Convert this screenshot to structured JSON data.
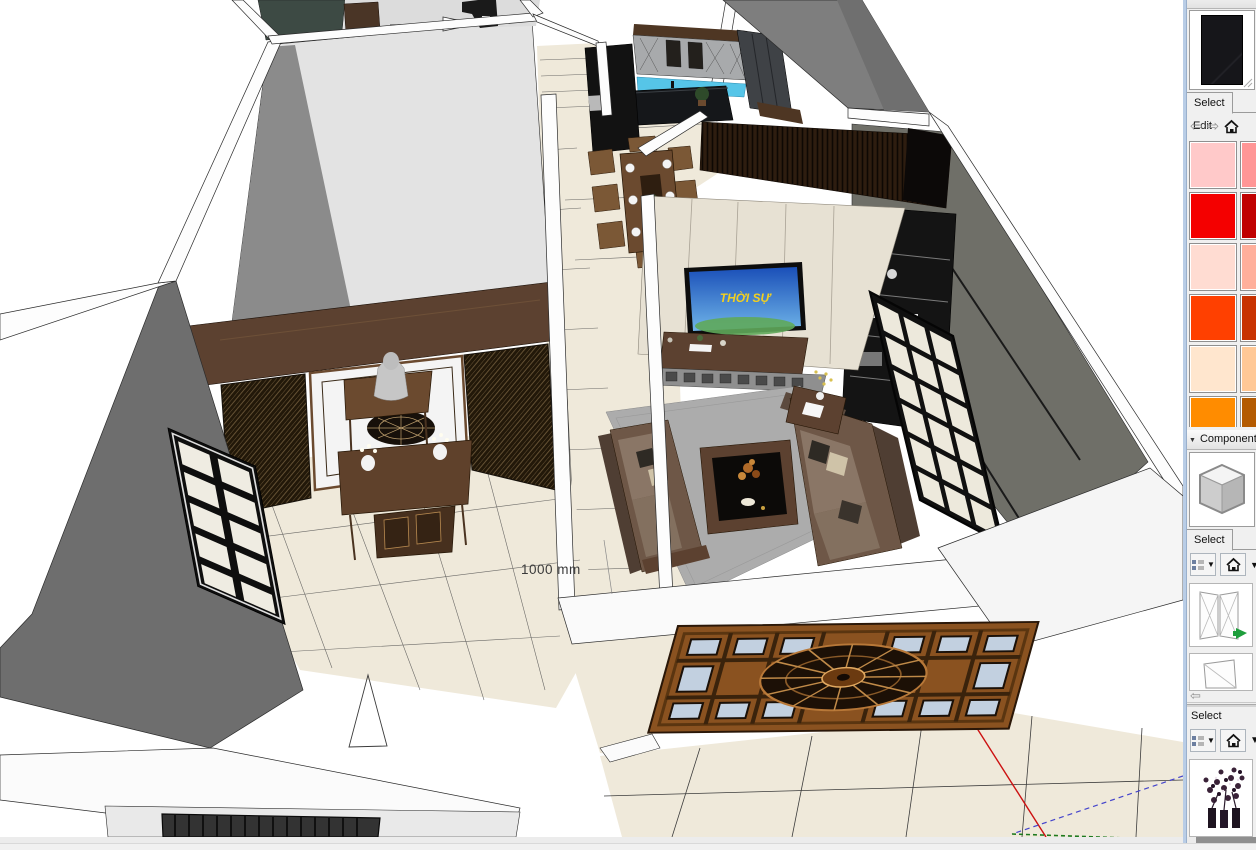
{
  "viewport": {
    "dimension_label": "1000 mm",
    "tv_screen_text": "THỜI SỰ"
  },
  "tray": {
    "materials": {
      "title": "Materials",
      "tab_select": "Select",
      "tab_edit": "Edit",
      "preview_material": "charcoal-marble",
      "colors": [
        "#ffc9c9",
        "#ff9696",
        "#f40000",
        "#c00000",
        "#ffdcd2",
        "#ffaf9b",
        "#ff4000",
        "#c83200",
        "#ffe6ce",
        "#ffc896",
        "#ff8c00",
        "#b45a00"
      ]
    },
    "components": {
      "title": "Components",
      "tab_select": "Select",
      "tab_edit": "Edit",
      "thumbnails": [
        "double-swing-door",
        "single-door"
      ],
      "secondary": {
        "label": "Select",
        "thumbnails": [
          "flower-vase-set"
        ]
      }
    }
  },
  "statusbar": {}
}
